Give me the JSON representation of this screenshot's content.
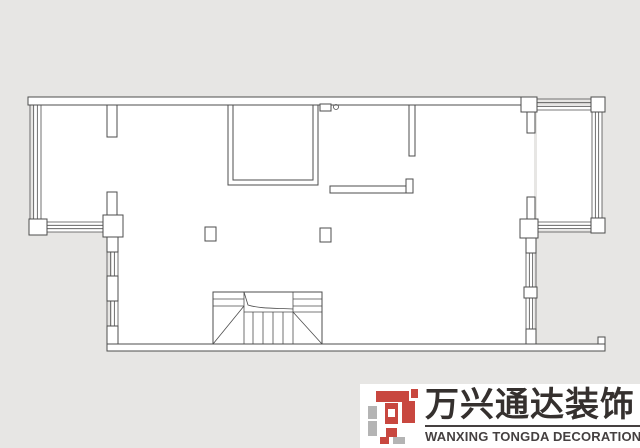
{
  "canvas": {
    "width": 640,
    "height": 448,
    "bg": "#e7e6e4",
    "line_color": "#4d4d4d",
    "fill": "#ffffff"
  },
  "logo": {
    "chinese": "万兴通达装饰",
    "english": "WANXING TONGDA DECORATION",
    "text_color": "#35302e",
    "english_color": "#454040",
    "colors": {
      "red": "#c8473f",
      "gray": "#b4b4b4",
      "white": "#ffffff"
    },
    "mark": {
      "viewbox": "0 0 50 55",
      "rects": [
        [
          8,
          2,
          33,
          11,
          "red"
        ],
        [
          43,
          0,
          7,
          9,
          "red"
        ],
        [
          0,
          17,
          9,
          13,
          "gray"
        ],
        [
          0,
          32,
          9,
          15,
          "gray"
        ],
        [
          17,
          14,
          13,
          21,
          "red"
        ],
        [
          20,
          20,
          7,
          8,
          "white"
        ],
        [
          18,
          39,
          11,
          9,
          "red"
        ],
        [
          34,
          12,
          13,
          22,
          "red"
        ],
        [
          12,
          48,
          9,
          7,
          "red"
        ],
        [
          25,
          48,
          12,
          7,
          "gray"
        ]
      ]
    }
  },
  "plan": {
    "interior_polygons": [
      [
        [
          34,
          101
        ],
        [
          534,
          101
        ],
        [
          534,
          344
        ],
        [
          112,
          344
        ],
        [
          112,
          232
        ],
        [
          34,
          232
        ]
      ],
      [
        [
          537,
          105
        ],
        [
          602,
          105
        ],
        [
          602,
          230
        ],
        [
          537,
          230
        ]
      ]
    ],
    "wall_rects": [
      [
        28,
        97,
        509,
        8,
        "fill"
      ],
      [
        107,
        105,
        10,
        32,
        "fill"
      ],
      [
        228,
        105,
        90,
        80,
        "none"
      ],
      [
        233,
        105,
        80,
        75,
        "none"
      ],
      [
        409,
        105,
        6,
        51,
        "fill"
      ],
      [
        521,
        97,
        16,
        15,
        "fill"
      ],
      [
        527,
        112,
        8,
        21,
        "fill"
      ],
      [
        591,
        97,
        14,
        15,
        "fill"
      ],
      [
        591,
        218,
        14,
        15,
        "fill"
      ],
      [
        527,
        197,
        8,
        22,
        "fill"
      ],
      [
        520,
        219,
        18,
        19,
        "fill"
      ],
      [
        526,
        238,
        10,
        15,
        "fill"
      ],
      [
        524,
        287,
        13,
        11,
        "fill"
      ],
      [
        526,
        329,
        10,
        15,
        "fill"
      ],
      [
        29,
        219,
        18,
        16,
        "fill"
      ],
      [
        103,
        215,
        20,
        22,
        "fill"
      ],
      [
        107,
        192,
        10,
        23,
        "fill"
      ],
      [
        107,
        237,
        11,
        15,
        "fill"
      ],
      [
        107,
        276,
        11,
        25,
        "fill"
      ],
      [
        107,
        326,
        11,
        22,
        "fill"
      ],
      [
        107,
        344,
        498,
        7,
        "fill"
      ],
      [
        598,
        337,
        7,
        7,
        "fill"
      ],
      [
        205,
        227,
        11,
        14,
        "fill"
      ],
      [
        320,
        228,
        11,
        14,
        "fill"
      ],
      [
        320,
        104,
        11,
        7,
        "fill"
      ],
      [
        330,
        186,
        83,
        7,
        "fill"
      ],
      [
        406,
        179,
        7,
        14,
        "fill"
      ],
      [
        213,
        292,
        109,
        52,
        "none"
      ]
    ],
    "window_bands": [
      {
        "x": 30,
        "y": 105,
        "w": 11,
        "h": 114,
        "dir": "v"
      },
      {
        "x": 47,
        "y": 222,
        "w": 56,
        "h": 10,
        "dir": "h"
      },
      {
        "x": 107,
        "y": 252,
        "w": 11,
        "h": 24,
        "dir": "v"
      },
      {
        "x": 107,
        "y": 301,
        "w": 11,
        "h": 25,
        "dir": "v"
      },
      {
        "x": 537,
        "y": 99,
        "w": 54,
        "h": 11,
        "dir": "h"
      },
      {
        "x": 592,
        "y": 112,
        "w": 10,
        "h": 106,
        "dir": "v"
      },
      {
        "x": 538,
        "y": 222,
        "w": 53,
        "h": 10,
        "dir": "h"
      },
      {
        "x": 526,
        "y": 253,
        "w": 10,
        "h": 34,
        "dir": "v"
      },
      {
        "x": 526,
        "y": 298,
        "w": 10,
        "h": 31,
        "dir": "v"
      }
    ],
    "lines": [
      [
        244,
        292,
        244,
        344
      ],
      [
        293,
        292,
        293,
        344
      ],
      [
        213,
        299,
        244,
        299
      ],
      [
        213,
        306,
        244,
        306
      ],
      [
        293,
        299,
        322,
        299
      ],
      [
        293,
        306,
        322,
        306
      ],
      [
        244,
        312,
        322,
        312
      ],
      [
        253,
        312,
        253,
        344
      ],
      [
        263,
        312,
        263,
        344
      ],
      [
        273,
        312,
        273,
        344
      ],
      [
        283,
        312,
        283,
        344
      ],
      [
        213,
        344,
        244,
        306
      ],
      [
        293,
        312,
        322,
        344
      ]
    ],
    "paths": [
      "M244,292 L248,305 C260,309 278,308 293,309"
    ],
    "circles": [
      [
        336,
        107,
        2.5
      ]
    ]
  }
}
